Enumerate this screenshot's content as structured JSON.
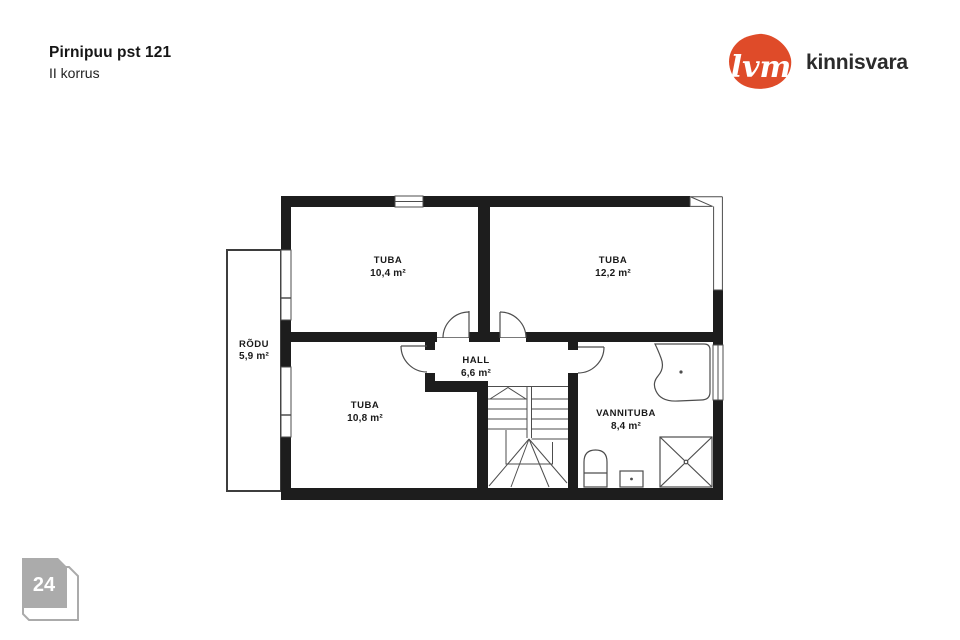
{
  "header": {
    "title": "Pirnipuu pst 121",
    "subtitle": "II korrus"
  },
  "logo": {
    "mark": "lvm",
    "name": "kinnisvara",
    "brand_color": "#df4b29",
    "text_color": "#2b2b2b"
  },
  "page_badge": {
    "number": "24",
    "color": "#ababab"
  },
  "floor_plan": {
    "colors": {
      "wall": "#1d1d1d",
      "line": "#4d4d4d"
    },
    "rooms": [
      {
        "name": "TUBA",
        "area": "10,4 m²"
      },
      {
        "name": "TUBA",
        "area": "12,2 m²"
      },
      {
        "name": "RÕDU",
        "area": "5,9 m²"
      },
      {
        "name": "TUBA",
        "area": "10,8 m²"
      },
      {
        "name": "HALL",
        "area": "6,6 m²"
      },
      {
        "name": "VANNITUBA",
        "area": "8,4 m²"
      }
    ]
  }
}
